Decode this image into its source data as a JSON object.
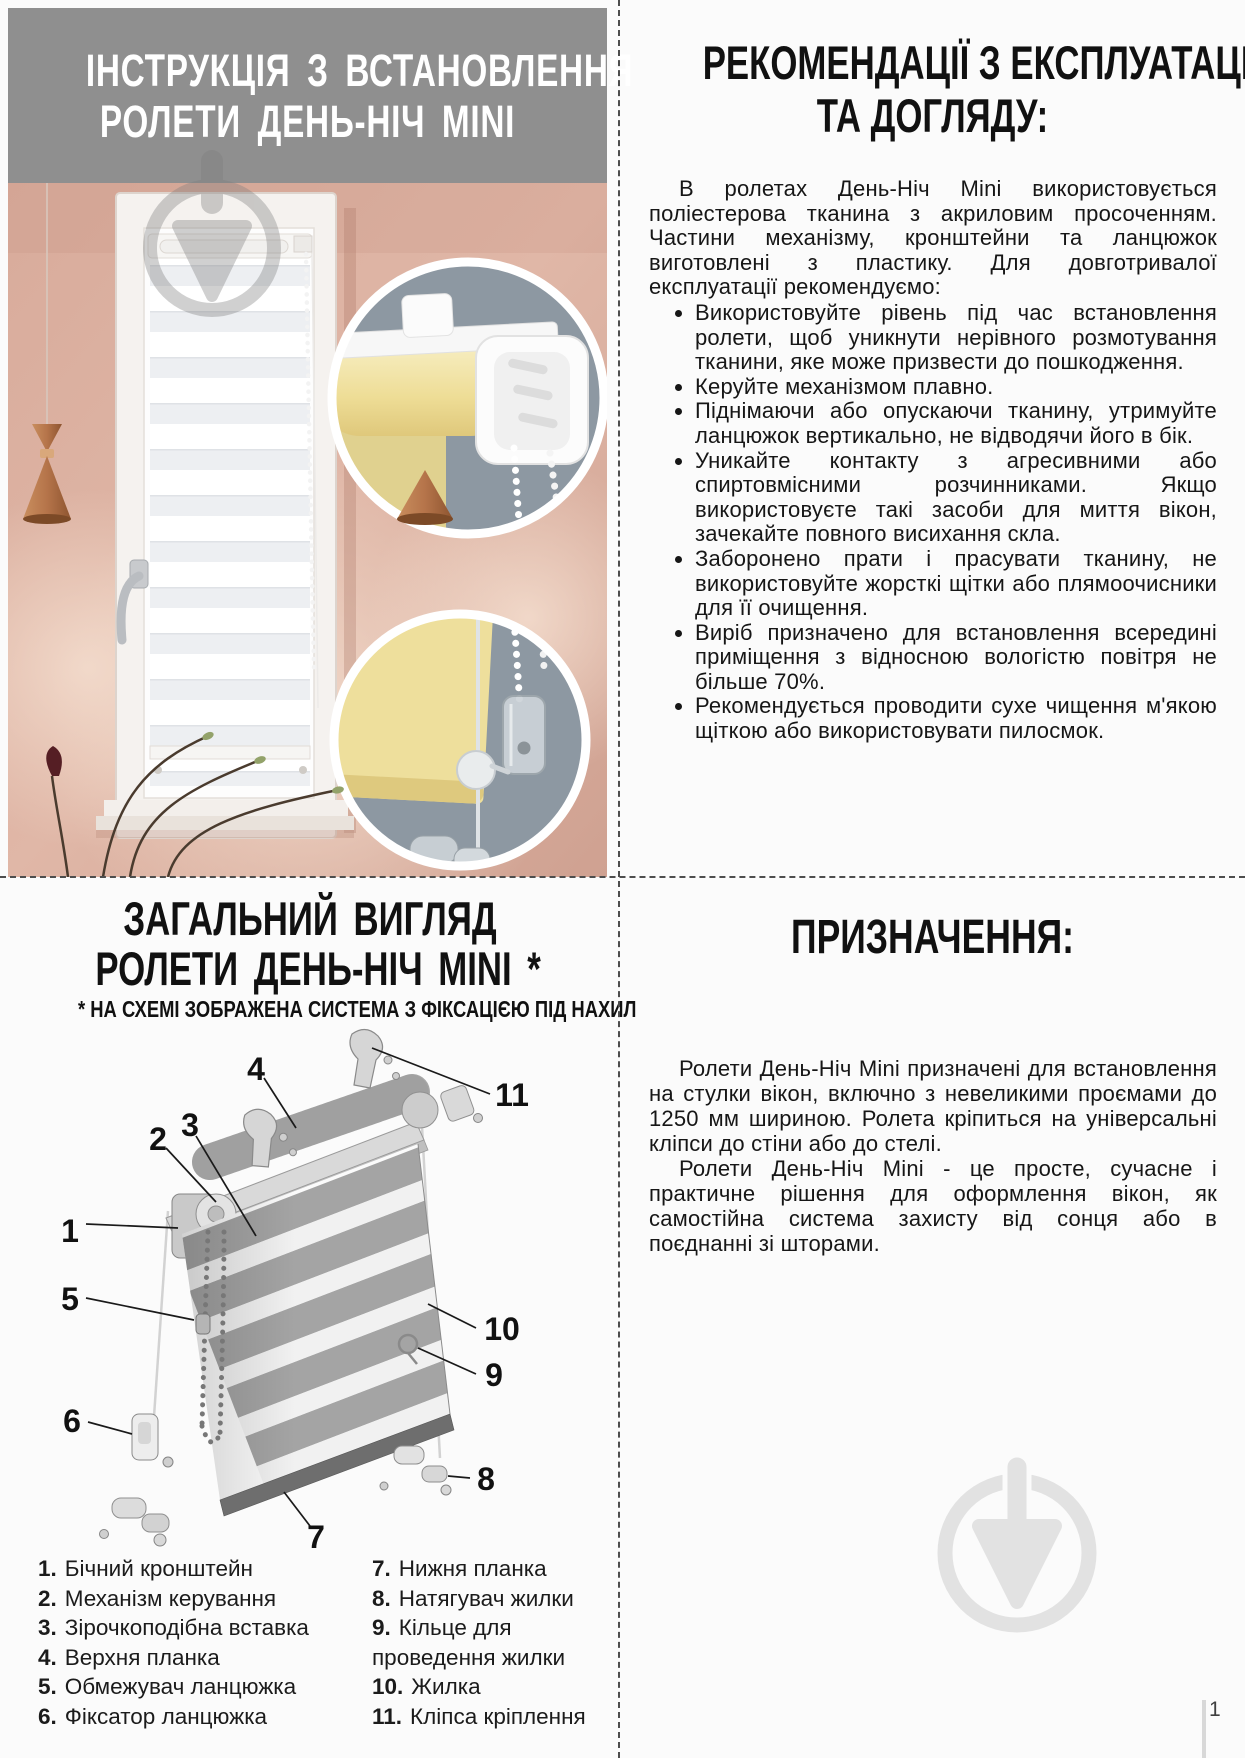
{
  "install": {
    "title_line1": "ІНСТРУКЦІЯ З ВСТАНОВЛЕННЯ",
    "title_line2": "РОЛЕТИ ДЕНЬ-НІЧ MINI"
  },
  "care": {
    "title_line1": "РЕКОМЕНДАЦІЇ З ЕКСПЛУАТАЦІЇ",
    "title_line2": "ТА ДОГЛЯДУ:",
    "intro": "В ролетах День-Ніч Mini використовується поліестерова тканина з акриловим просоченням. Частини механізму, кронштейни та ланцюжок виготовлені з пластику. Для довготривалої експлуатації рекомендуємо:",
    "bullets": [
      "Використовуйте рівень під час встановлення ролети, щоб уникнути нерівного розмотування тканини, яке може призвести до пошкодження.",
      "Керуйте механізмом плавно.",
      "Піднімаючи або опускаючи тканину, утримуйте ланцюжок вертикально, не відводячи його в бік.",
      "Уникайте контакту з агресивними або спиртовмісними розчинниками. Якщо використовуєте такі засоби для миття вікон, зачекайте повного висихання скла.",
      "Заборонено прати і прасувати тканину, не використовуйте жорсткі щітки або плямоочисники для її очищення.",
      "Виріб призначено для встановлення всередині приміщення з відносною вологістю повітря не більше 70%.",
      "Рекомендується проводити сухе чищення м'якою щіткою або використовувати пилосмок."
    ]
  },
  "overview": {
    "title_line1": "ЗАГАЛЬНИЙ ВИГЛЯД",
    "title_line2": "РОЛЕТИ ДЕНЬ-НІЧ MINI *",
    "subtitle": "* НА СХЕМІ ЗОБРАЖЕНА СИСТЕМА З ФІКСАЦІЄЮ ПІД НАХИЛ",
    "callouts": [
      "1",
      "2",
      "3",
      "4",
      "5",
      "6",
      "7",
      "8",
      "9",
      "10",
      "11"
    ],
    "legend_left": [
      {
        "num": "1.",
        "label": "Бічний кронштейн"
      },
      {
        "num": "2.",
        "label": "Механізм керування"
      },
      {
        "num": "3.",
        "label": "Зірочкоподібна вставка"
      },
      {
        "num": "4.",
        "label": "Верхня планка"
      },
      {
        "num": "5.",
        "label": "Обмежувач ланцюжка"
      },
      {
        "num": "6.",
        "label": "Фіксатор ланцюжка"
      }
    ],
    "legend_right": [
      {
        "num": "7.",
        "label": "Нижня планка"
      },
      {
        "num": "8.",
        "label": "Натягувач жилки"
      },
      {
        "num": "9.",
        "label": "Кільце для проведення жилки"
      },
      {
        "num": "10.",
        "label": "Жилка"
      },
      {
        "num": "11.",
        "label": "Кліпса кріплення"
      }
    ]
  },
  "purpose": {
    "title": "ПРИЗНАЧЕННЯ:",
    "p1": "Ролети День-Ніч Mini призначені для встановлення на стулки вікон, включно з невеликими проємами до 1250 мм шириною. Ролета кріпиться на універсальні кліпси до стіни або до стелі.",
    "p2": "Ролети День-Ніч Mini - це просте, сучасне і практичне рішення для оформлення вікон, як самостійна система захисту від сонця або в поєднанні зі шторами."
  },
  "footer": {
    "page_number": "1"
  },
  "colors": {
    "header_gray": "#8f8f8f",
    "text": "#161616",
    "wall_pink": "#dcb2a2",
    "inset_slate": "#8d98a2",
    "fabric_yellow": "#efe09e",
    "copper": "#b5744a",
    "watermark_gray": "#e2e2e2"
  }
}
